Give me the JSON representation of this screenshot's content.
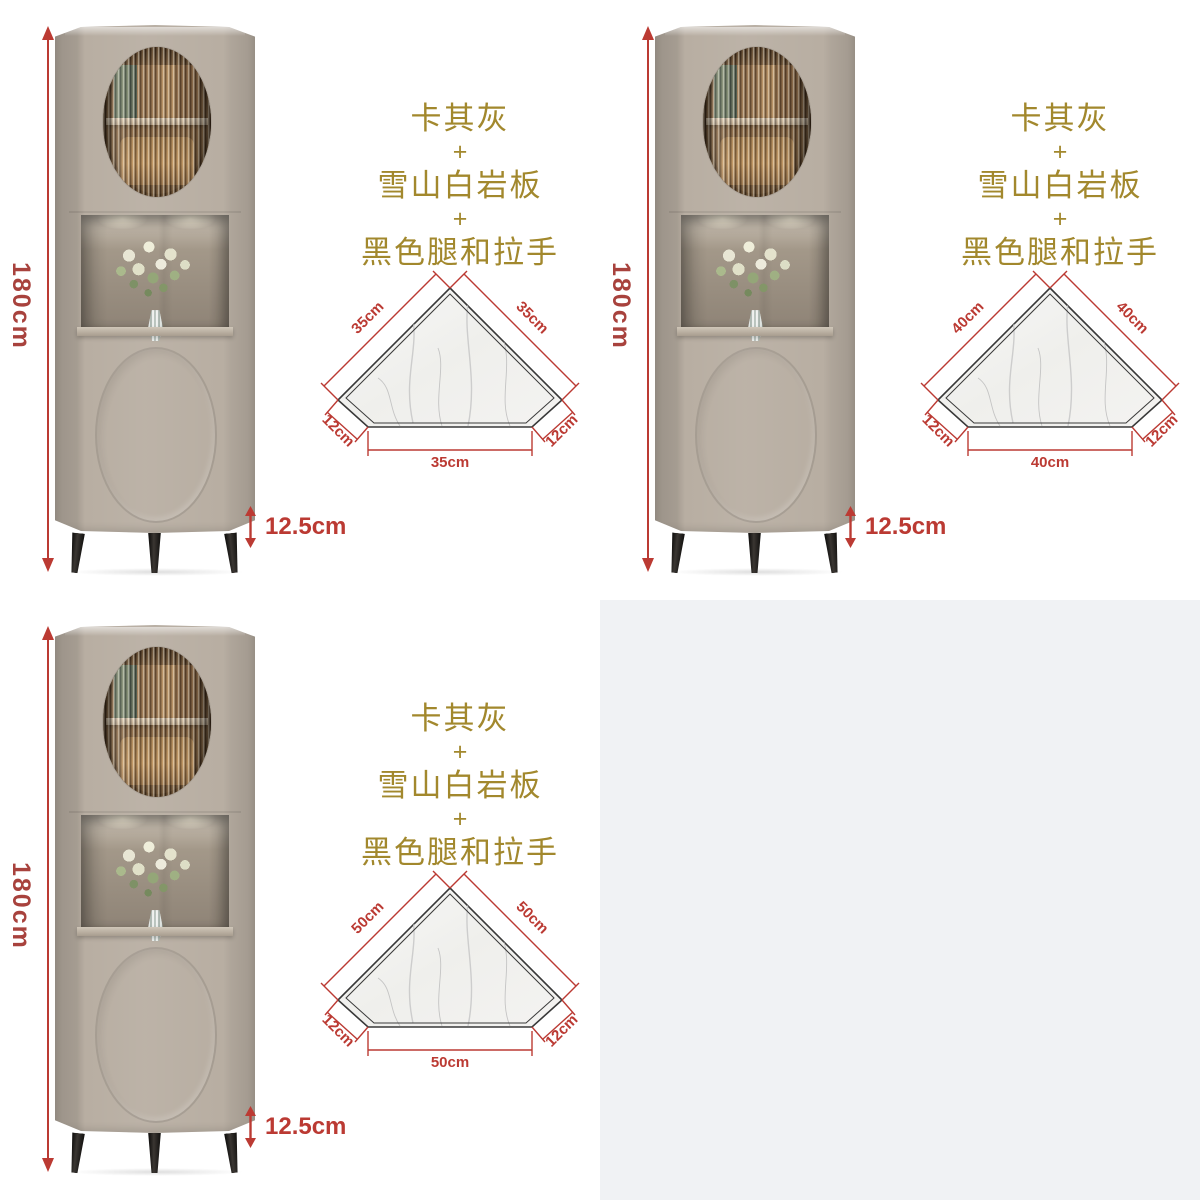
{
  "page": {
    "background": "#ffffff",
    "empty_quadrant_color": "#f0f2f4"
  },
  "colors": {
    "dimension_red": "#bb3a33",
    "height_label_red": "#a8423d",
    "finish_gold": "#a2882d",
    "cabinet_body": "#b8aea2",
    "marble_white": "#f3f2f0",
    "outline_dark": "#383838",
    "leg_black": "#1d1c1b"
  },
  "panels": [
    {
      "variant": "35cm",
      "height_label": "180cm",
      "leg_height_label": "12.5cm",
      "finish_lines": [
        "卡其灰",
        "+",
        "雪山白岩板",
        "+",
        "黑色腿和拉手"
      ],
      "top_view": {
        "left_edge": "35cm",
        "right_edge": "35cm",
        "left_cut": "12cm",
        "right_cut": "12cm",
        "bottom_edge": "35cm"
      }
    },
    {
      "variant": "40cm",
      "height_label": "180cm",
      "leg_height_label": "12.5cm",
      "finish_lines": [
        "卡其灰",
        "+",
        "雪山白岩板",
        "+",
        "黑色腿和拉手"
      ],
      "top_view": {
        "left_edge": "40cm",
        "right_edge": "40cm",
        "left_cut": "12cm",
        "right_cut": "12cm",
        "bottom_edge": "40cm"
      }
    },
    {
      "variant": "50cm",
      "height_label": "180cm",
      "leg_height_label": "12.5cm",
      "finish_lines": [
        "卡其灰",
        "+",
        "雪山白岩板",
        "+",
        "黑色腿和拉手"
      ],
      "top_view": {
        "left_edge": "50cm",
        "right_edge": "50cm",
        "left_cut": "12cm",
        "right_cut": "12cm",
        "bottom_edge": "50cm"
      }
    }
  ]
}
